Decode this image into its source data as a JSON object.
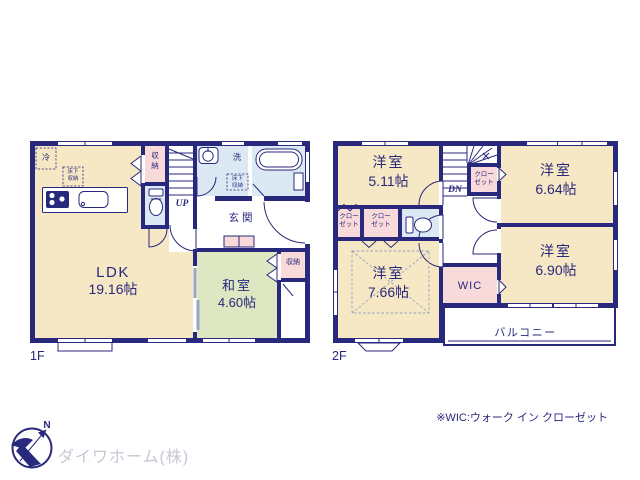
{
  "colors": {
    "wall": "#28287c",
    "cream": "#f7e8c5",
    "green": "#dde7c2",
    "pink": "#f8dada",
    "blue": "#dce9f4",
    "gray": "#c7c7d4"
  },
  "floor1": {
    "label": "1F",
    "ldk_name": "LDK",
    "ldk_size": "19.16帖",
    "washitsu_name": "和室",
    "washitsu_size": "4.60帖",
    "fridge": "冷",
    "underfloor1": "床下収納",
    "storage_hall": "収納",
    "storage_washitsu": "収納",
    "laundry": "洗",
    "underfloor2": "床下収納",
    "genkan": "玄関",
    "up": "UP"
  },
  "floor2": {
    "label": "2F",
    "room_nw_name": "洋室",
    "room_nw_size": "5.11帖",
    "room_ne_name": "洋室",
    "room_ne_size": "6.64帖",
    "room_se_name": "洋室",
    "room_se_size": "6.90帖",
    "room_sw_name": "洋室",
    "room_sw_size": "7.66帖",
    "closet1": "クローゼット",
    "closet2": "クローゼット",
    "closet3": "クローゼット",
    "wic": "WIC",
    "balcony": "バルコニー",
    "dn": "DN"
  },
  "footer": {
    "company": "ダイワホーム(株)",
    "wic_note": "※WIC:ウォーク イン クローゼット",
    "north_label": "N"
  }
}
